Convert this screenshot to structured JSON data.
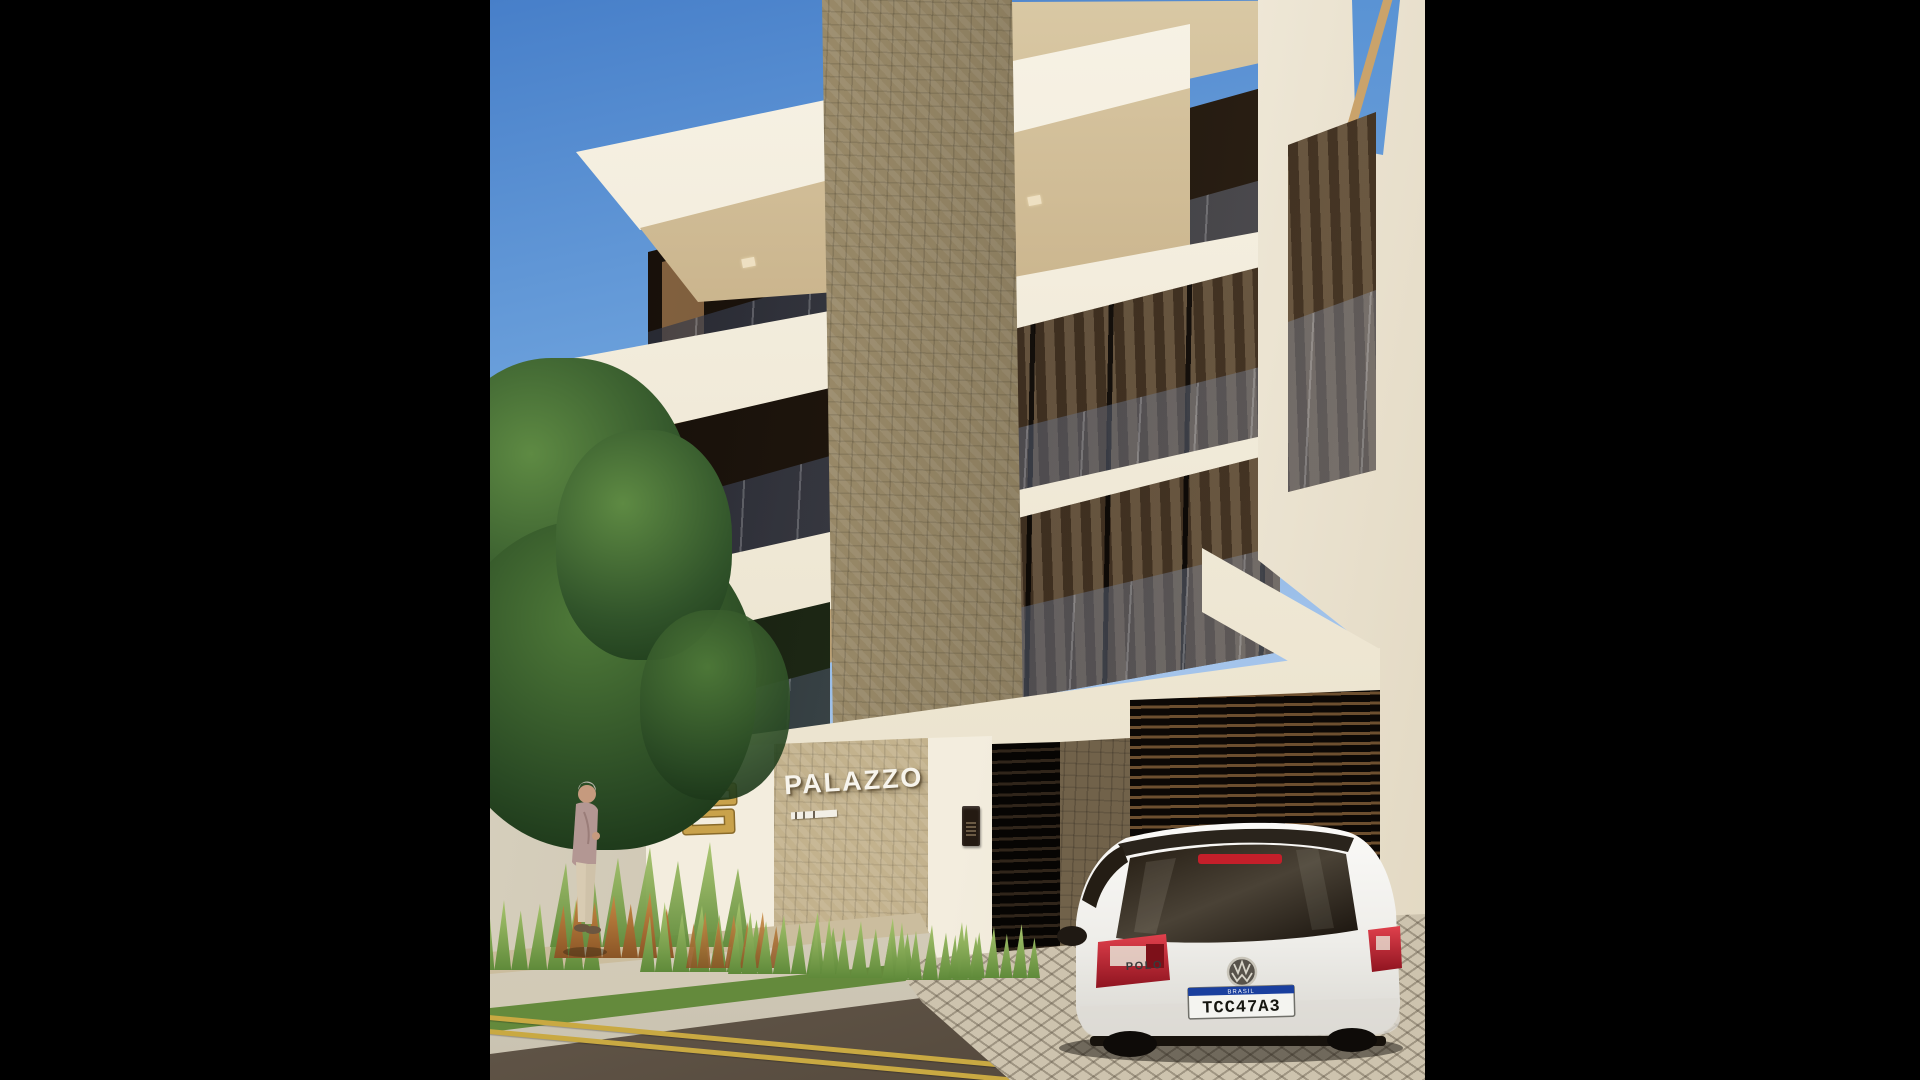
{
  "scene": {
    "kind": "3D architectural exterior render, pillarboxed with black side bars",
    "subject": "Modern multi-storey residence with mosaic tile core, cream balcony slabs, street-level gates and a white hatchback parked at the driveway"
  },
  "signage": {
    "building_name": "PALAZZO",
    "emblem_icon": "gold-monogram-emblem",
    "subplaque": "small illegible caption plaque"
  },
  "car": {
    "brand_icon": "vw-roundel",
    "model_badge": "POLO",
    "plate_band": "BRASIL",
    "plate_number": "TCC47A3"
  },
  "palette": {
    "sky_top": "#477fc9",
    "sky_horizon": "#d3e2f5",
    "slab_cream": "#f3eee1",
    "soffit_tan": "#bda378",
    "mosaic_tile": "#9c8c6a",
    "sign_tile": "#c3b28d",
    "balcony_glass": "#545e74",
    "gold_emblem": "#c9a24b",
    "foliage": "#31542a",
    "ornamental_grass": "#7fa653",
    "asphalt": "#7d7060",
    "lane_line_yellow": "#c9a942",
    "taillight_red": "#c41f2a",
    "plate_band_blue": "#1a3f9e",
    "car_body": "#f2f1ee"
  }
}
